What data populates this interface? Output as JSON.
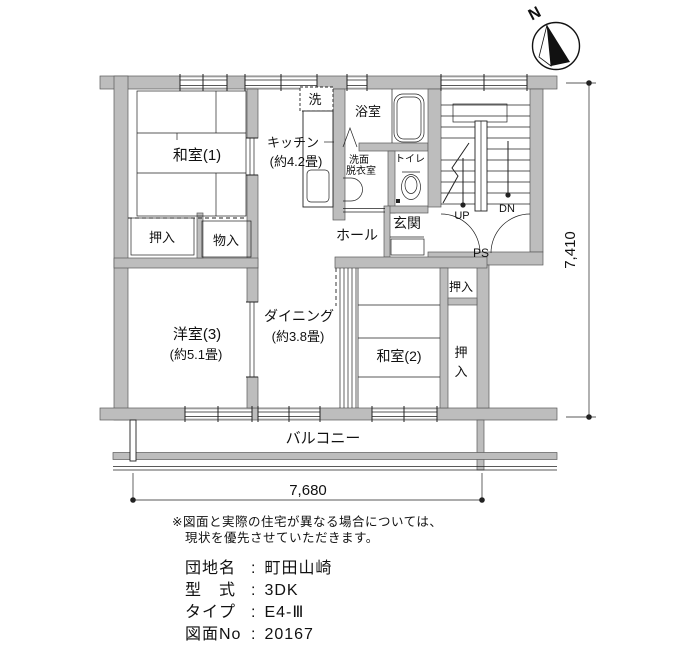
{
  "colors": {
    "wall_fill": "#bdbdbd",
    "line": "#222222"
  },
  "compass": {
    "north": "N"
  },
  "plan": {
    "rooms": {
      "washitsu1": {
        "name": "和室(1)"
      },
      "kitchen": {
        "name": "キッチン",
        "size": "(約4.2畳)"
      },
      "laundry": {
        "name": "洗"
      },
      "bath": {
        "name": "浴室"
      },
      "washroom": {
        "line1": "洗面",
        "line2": "脱衣室"
      },
      "toilet": {
        "name": "トイレ"
      },
      "genkan": {
        "name": "玄関"
      },
      "hall": {
        "name": "ホール"
      },
      "oshiire1": {
        "name": "押入"
      },
      "monoire": {
        "name": "物入"
      },
      "yoshitsu3": {
        "name": "洋室(3)",
        "size": "(約5.1畳)"
      },
      "dining": {
        "name": "ダイニング",
        "size": "(約3.8畳)"
      },
      "washitsu2": {
        "name": "和室(2)"
      },
      "oshiire2a": {
        "name": "押入"
      },
      "oshiire2b": {
        "char1": "押",
        "char2": "入"
      },
      "balcony": {
        "name": "バルコニー"
      }
    },
    "stairs": {
      "up": "UP",
      "dn": "DN",
      "ps": "PS"
    },
    "dims": {
      "width": "7,680",
      "height": "7,410"
    }
  },
  "notes": {
    "line1": "※図面と実際の住宅が異なる場合については、",
    "line2": "現状を優先させていただきます。"
  },
  "info": {
    "colon": ":",
    "rows": [
      {
        "label": "団地名",
        "value": "町田山崎"
      },
      {
        "label": "型　式",
        "value": "3DK"
      },
      {
        "label": "タイプ",
        "value": "E4-Ⅲ"
      },
      {
        "label": "図面No",
        "value": "20167"
      }
    ]
  }
}
